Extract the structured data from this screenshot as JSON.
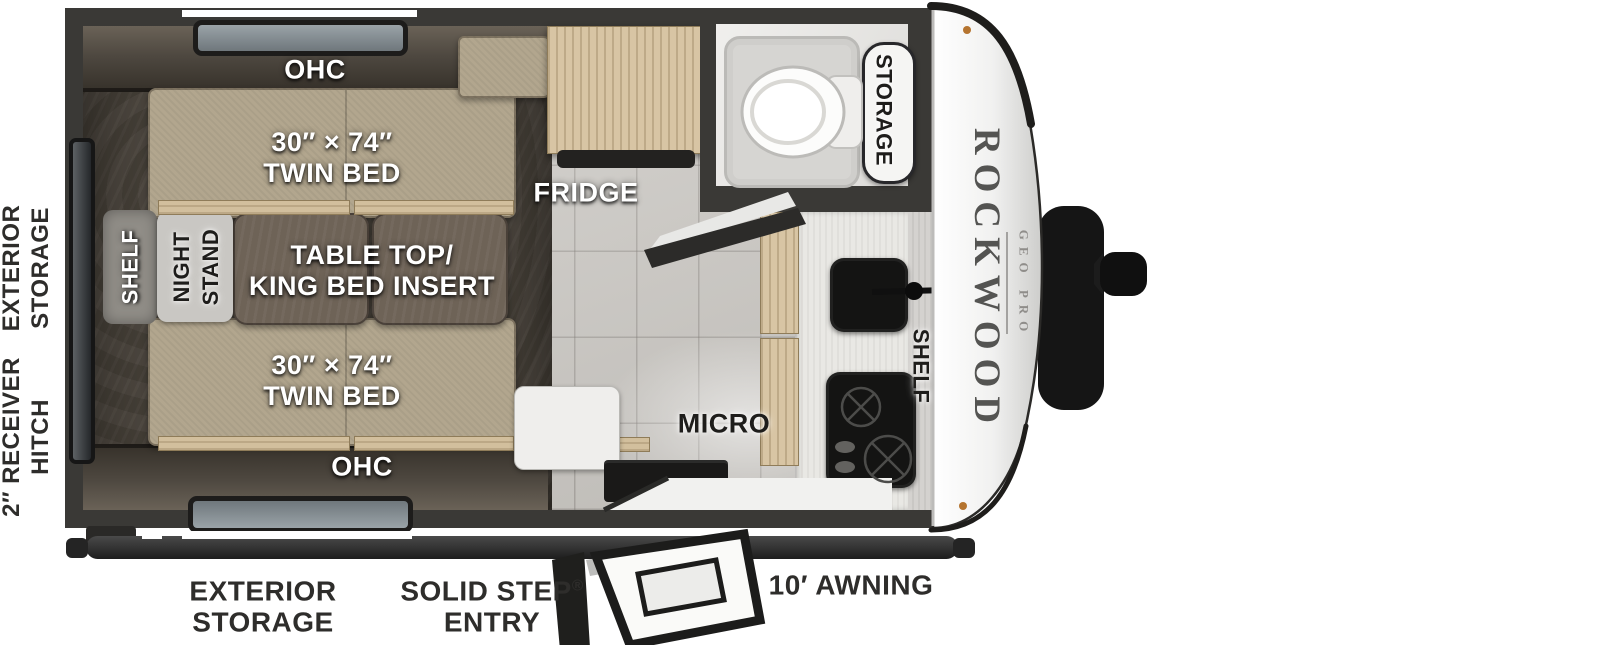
{
  "branding": {
    "name": "ROCKWOOD",
    "model": "GEO PRO"
  },
  "exterior_labels": {
    "left_top_line1": "EXTERIOR",
    "left_top_line2": "STORAGE",
    "left_bottom_line1": "2″ RECEIVER",
    "left_bottom_line2": "HITCH",
    "bottom_storage_line1": "EXTERIOR",
    "bottom_storage_line2": "STORAGE",
    "bottom_entry_line1": "SOLID STEP",
    "bottom_entry_reg": "®",
    "bottom_entry_line2": "ENTRY",
    "bottom_awning": "10′ AWNING"
  },
  "interior_labels": {
    "ohc_top": "OHC",
    "ohc_bottom": "OHC",
    "bed_top_size": "30″ × 74″",
    "bed_top_name": "TWIN BED",
    "bed_bottom_size": "30″ × 74″",
    "bed_bottom_name": "TWIN BED",
    "table_line1": "TABLE TOP/",
    "table_line2": "KING BED INSERT",
    "shelf_bedroom": "SHELF",
    "nightstand_line1": "NIGHT",
    "nightstand_line2": "STAND",
    "fridge": "FRIDGE",
    "bath_storage": "STORAGE",
    "micro": "MICRO",
    "shelf_kitchen": "SHELF"
  },
  "colors": {
    "wall": "#3a3936",
    "bed": "#b2a68e",
    "table_insert": "#6e6357",
    "cabinet_wood": "#d8c5a4",
    "floor_tile": "#c9c6c1",
    "appliance_black": "#141413",
    "label_dark": "#2e2d2b",
    "cap_white": "#f5f5f4"
  }
}
